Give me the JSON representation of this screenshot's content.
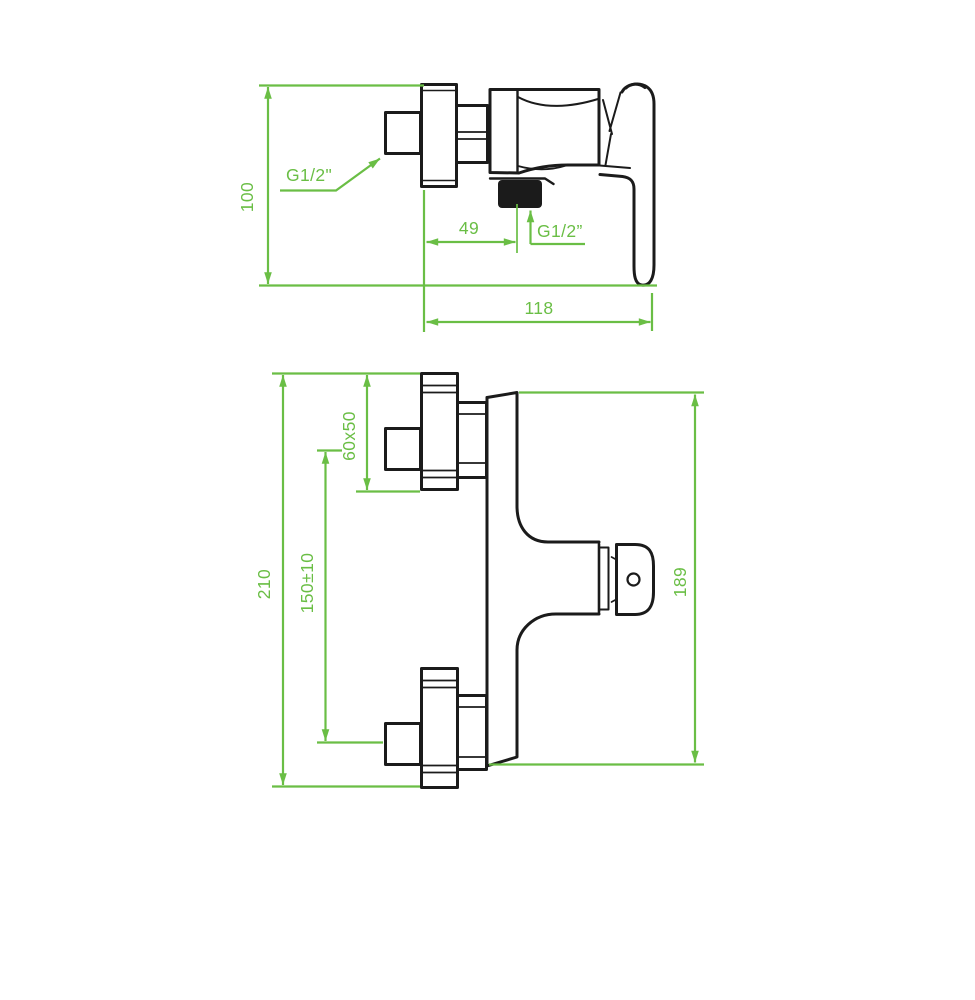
{
  "page": {
    "background": "#ffffff",
    "content_type": "technical dimensional drawing of a wall-mounted single-lever shower mixer tap, two orthographic views"
  },
  "colors": {
    "dimension_green": "#6abe45",
    "drawing_black": "#1b1b1b"
  },
  "drawing": {
    "top_view": {
      "height_label": "100",
      "inlet_thread_label": "G1/2\"",
      "spout_offset_label": "49",
      "spout_thread_label": "G1/2”",
      "width_label": "118"
    },
    "front_view": {
      "overall_height_label": "210",
      "connection_spacing_label": "150±10",
      "flange_size_label": "60x50",
      "body_height_label": "189"
    }
  }
}
